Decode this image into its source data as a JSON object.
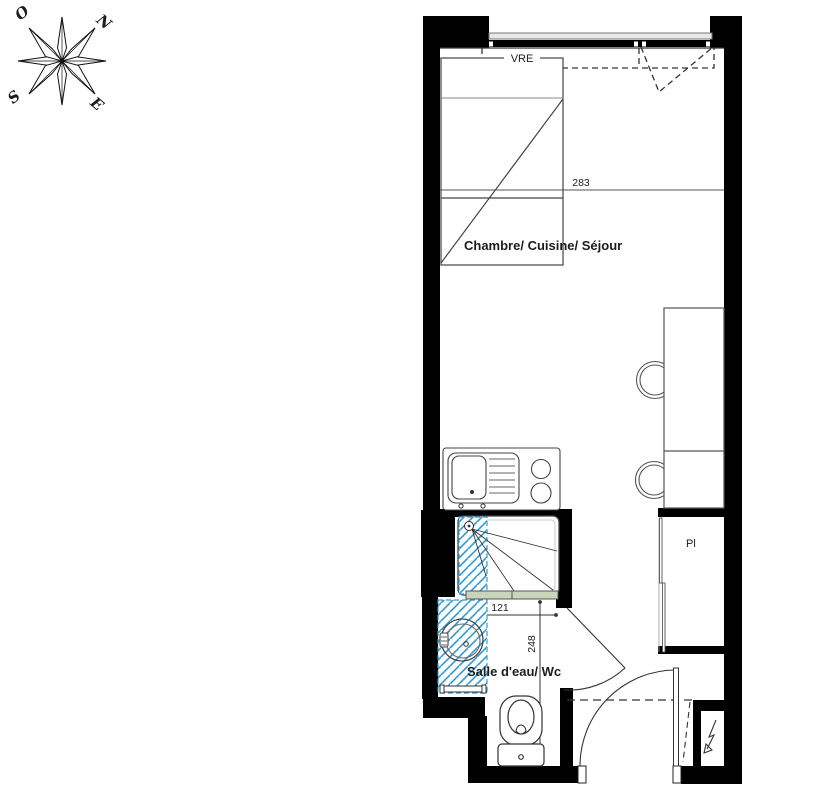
{
  "compass": {
    "north": "N",
    "south": "S",
    "east": "E",
    "west": "O"
  },
  "plan": {
    "window_label": "VRE",
    "room_main": "Chambre/ Cuisine/ Séjour",
    "room_bath": "Salle d'eau/ Wc",
    "closet_label": "Pl",
    "dim_main_width": "283",
    "dim_bath_width": "121",
    "dim_bath_length": "248"
  },
  "colors": {
    "wall": "#000000",
    "hatch_blue": "#2f9bd6",
    "glass_green": "#c9d5ba",
    "line_dark": "#3a3a3a"
  }
}
